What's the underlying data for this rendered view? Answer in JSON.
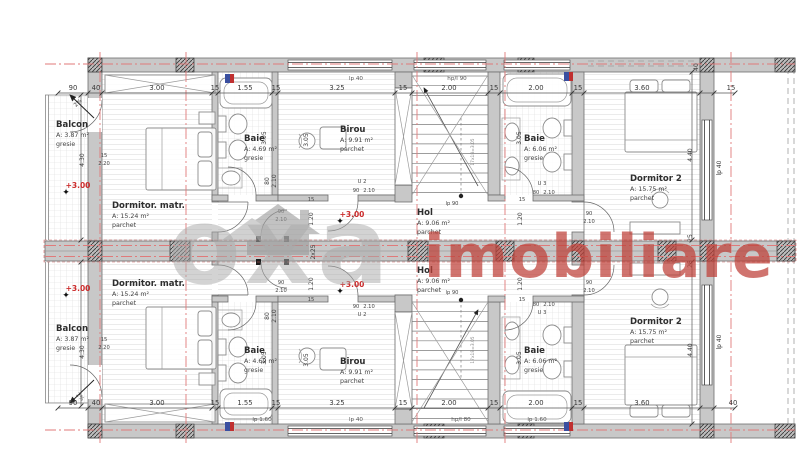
{
  "meta": {
    "type": "architectural-floor-plan",
    "units": "two mirrored apartments"
  },
  "watermark": {
    "brand": "oxa",
    "suffix": "imobiliare"
  },
  "colors": {
    "wall": "#c8c8c8",
    "axis_red": "#e07a7a",
    "accent_red": "#cc2b2b",
    "watermark_gray": "#a9a9a9",
    "watermark_red": "#bf4038",
    "text": "#2e2e2e",
    "dim_text": "#3a3a3a",
    "sub_text": "#555555",
    "stamp_blue": "#3a4fa0",
    "stamp_red": "#c03030"
  },
  "rooms": [
    {
      "id": "balcon-1",
      "name": "Balcon",
      "area": "A: 3.87 m²",
      "floor": "gresie",
      "x": 56,
      "y": 127
    },
    {
      "id": "dormitor-matr-1",
      "name": "Dormitor. matr.",
      "area": "A: 15.24 m²",
      "floor": "parchet",
      "x": 112,
      "y": 208
    },
    {
      "id": "baie-mica-1",
      "name": "Baie",
      "area": "A: 4.69 m²",
      "floor": "gresie",
      "x": 244,
      "y": 141
    },
    {
      "id": "birou-1",
      "name": "Birou",
      "area": "A: 9.91 m²",
      "floor": "parchet",
      "x": 340,
      "y": 132
    },
    {
      "id": "hol-1",
      "name": "Hol",
      "area": "A: 9.06 m²",
      "floor": "parchet",
      "x": 417,
      "y": 215
    },
    {
      "id": "baie-mare-1",
      "name": "Baie",
      "area": "A: 6.06 m²",
      "floor": "gresie",
      "x": 524,
      "y": 141
    },
    {
      "id": "dormitor-2-1",
      "name": "Dormitor  2",
      "area": "A: 15.75 m²",
      "floor": "parchet",
      "x": 630,
      "y": 181
    },
    {
      "id": "hol-2",
      "name": "Hol",
      "area": "A: 9.06 m²",
      "floor": "parchet",
      "x": 417,
      "y": 273
    },
    {
      "id": "dormitor-matr-2",
      "name": "Dormitor. matr.",
      "area": "A: 15.24 m²",
      "floor": "parchet",
      "x": 112,
      "y": 286
    },
    {
      "id": "balcon-2",
      "name": "Balcon",
      "area": "A: 3.87 m²",
      "floor": "gresie",
      "x": 56,
      "y": 331
    },
    {
      "id": "baie-mica-2",
      "name": "Baie",
      "area": "A: 4.69 m²",
      "floor": "gresie",
      "x": 244,
      "y": 353
    },
    {
      "id": "birou-2",
      "name": "Birou",
      "area": "A: 9.91 m²",
      "floor": "parchet",
      "x": 340,
      "y": 364
    },
    {
      "id": "baie-mare-2",
      "name": "Baie",
      "area": "A: 6.06 m²",
      "floor": "gresie",
      "x": 524,
      "y": 353
    },
    {
      "id": "dormitor-2-2",
      "name": "Dormitor 2",
      "area": "A: 15.75 m²",
      "floor": "parchet",
      "x": 630,
      "y": 324
    }
  ],
  "levels": {
    "label": "+3.00",
    "spots": [
      [
        78,
        188
      ],
      [
        352,
        217
      ],
      [
        78,
        291
      ],
      [
        352,
        287
      ]
    ]
  },
  "dims": {
    "top": {
      "y": 90,
      "items": [
        [
          "90",
          73
        ],
        [
          "40",
          96
        ],
        [
          "3.00",
          157
        ],
        [
          "15",
          215
        ],
        [
          "1.55",
          245
        ],
        [
          "15",
          276
        ],
        [
          "3.25",
          337
        ],
        [
          "15",
          403
        ],
        [
          "2.00",
          449
        ],
        [
          "15",
          494
        ],
        [
          "2.00",
          536
        ],
        [
          "15",
          578
        ],
        [
          "3.60",
          642
        ],
        [
          "15",
          731
        ]
      ]
    },
    "top_sub": [
      [
        "lp 40",
        356,
        80
      ],
      [
        "hp/l 90",
        457,
        80
      ]
    ],
    "bottom": {
      "y": 405,
      "items": [
        [
          "90",
          73
        ],
        [
          "40",
          96
        ],
        [
          "3.00",
          157
        ],
        [
          "15",
          215
        ],
        [
          "1.55",
          245
        ],
        [
          "15",
          276
        ],
        [
          "3.25",
          337
        ],
        [
          "15",
          403
        ],
        [
          "2.00",
          449
        ],
        [
          "15",
          494
        ],
        [
          "2.00",
          536
        ],
        [
          "15",
          578
        ],
        [
          "3.60",
          642
        ],
        [
          "40",
          733
        ]
      ]
    },
    "bottom_sub": [
      [
        "lp 1.60",
        262,
        421
      ],
      [
        "lp 40",
        356,
        421
      ],
      [
        "hp/l 80",
        461,
        421
      ],
      [
        "lp 1.60",
        537,
        421
      ]
    ],
    "rotated": [
      [
        "4.30",
        84,
        160
      ],
      [
        "4.30",
        84,
        352
      ],
      [
        "4.40",
        692,
        155
      ],
      [
        "lp 40",
        721,
        168
      ],
      [
        "25",
        692,
        238
      ],
      [
        "25",
        692,
        264
      ],
      [
        "4.40",
        692,
        350
      ],
      [
        "lp 40",
        721,
        342
      ],
      [
        "40",
        698,
        67
      ],
      [
        "2x25",
        315,
        252
      ],
      [
        "3.05",
        266,
        138
      ],
      [
        "3.05",
        308,
        140
      ],
      [
        "3.05",
        521,
        138
      ],
      [
        "3.05",
        266,
        358
      ],
      [
        "3.05",
        308,
        360
      ],
      [
        "3.05",
        521,
        358
      ],
      [
        "1.20",
        313,
        219
      ],
      [
        "1.20",
        313,
        284
      ],
      [
        "1.20",
        522,
        219
      ],
      [
        "1.20",
        522,
        284
      ],
      [
        "80",
        269,
        181
      ],
      [
        "2.10",
        276,
        181
      ],
      [
        "80",
        269,
        316
      ],
      [
        "2.10",
        276,
        316
      ]
    ],
    "tiny": [
      [
        "15",
        311,
        201
      ],
      [
        "15",
        311,
        301
      ],
      [
        "15",
        522,
        201
      ],
      [
        "15",
        522,
        301
      ],
      [
        "90",
        281,
        213
      ],
      [
        "2.10",
        281,
        221
      ],
      [
        "90",
        281,
        284
      ],
      [
        "2.10",
        281,
        292
      ],
      [
        "U 2",
        362,
        183
      ],
      [
        "90",
        356,
        192
      ],
      [
        "2.10",
        369,
        192
      ],
      [
        "U 2",
        362,
        316
      ],
      [
        "90",
        356,
        308
      ],
      [
        "2.10",
        369,
        308
      ],
      [
        "U 3",
        542,
        185
      ],
      [
        "80",
        536,
        194
      ],
      [
        "2.10",
        549,
        194
      ],
      [
        "U 3",
        542,
        314
      ],
      [
        "80",
        536,
        306
      ],
      [
        "2.10",
        549,
        306
      ],
      [
        "90",
        589,
        215
      ],
      [
        "2.10",
        589,
        223
      ],
      [
        "90",
        589,
        284
      ],
      [
        "2.10",
        589,
        292
      ],
      [
        "lp 90",
        452,
        205
      ],
      [
        "lp 90",
        452,
        294
      ],
      [
        "15",
        104,
        157
      ],
      [
        "2.20",
        104,
        165
      ],
      [
        "15",
        104,
        341
      ],
      [
        "2.20",
        104,
        349
      ]
    ],
    "slope": [
      [
        "2%",
        79,
        104,
        -45
      ],
      [
        "2%",
        79,
        398,
        45
      ]
    ],
    "stair_note": [
      [
        "17x18=3.05",
        474,
        152
      ],
      [
        "17x18=3.05",
        474,
        350
      ]
    ]
  }
}
